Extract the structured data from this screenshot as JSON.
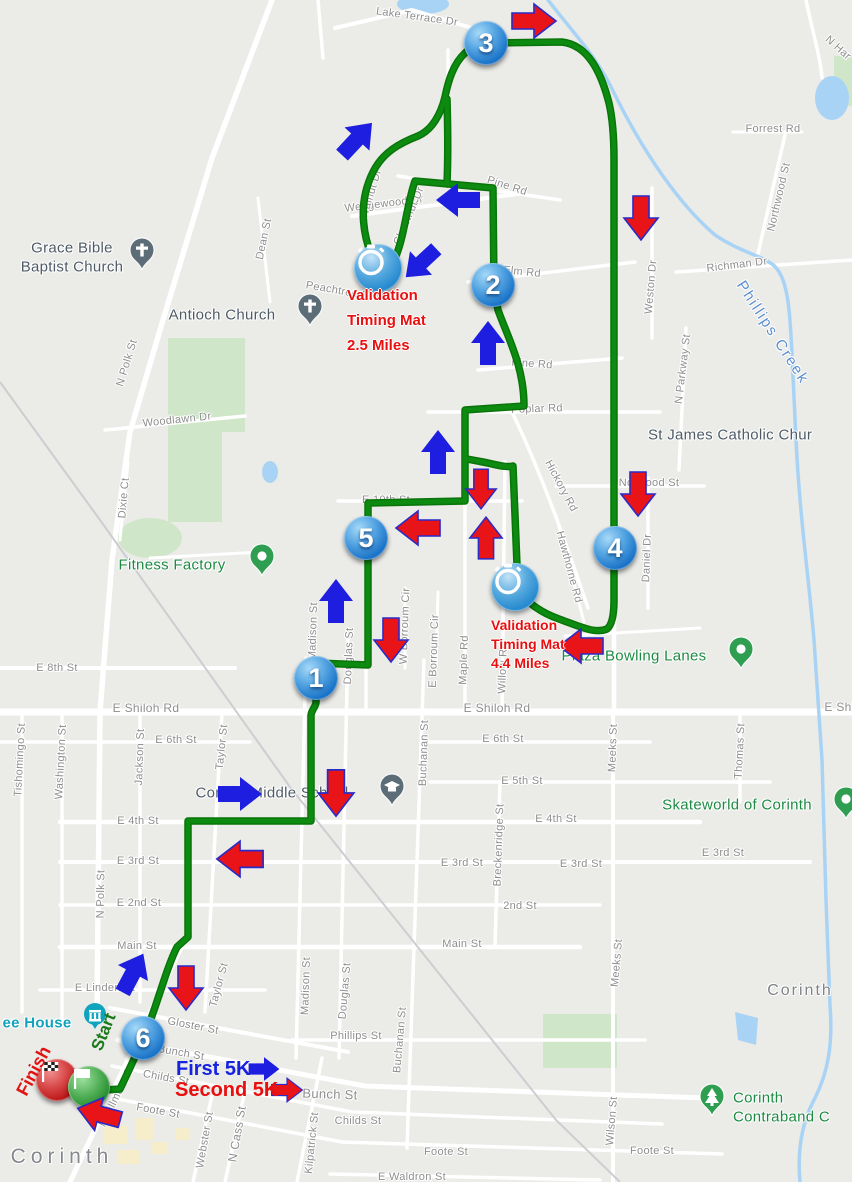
{
  "map": {
    "bg": "#ebebe8",
    "road_color": "#ffffff",
    "park_color": "#cfe7c8",
    "water_color": "#a9d3f5",
    "railroad_color": "#cdcdd2",
    "route_color": "#0d8a10",
    "route_casing_color": "#097409",
    "arrow_blue": "#1e1ee0",
    "arrow_red": "#e81418",
    "arrow_red_outline": "#2a2ac8",
    "parks": [
      "M 168,338 L 245,338 L 245,432 L 222,432 L 222,522 L 168,522 Z",
      "M 543,1014 h 74 v 54 h -74 Z",
      "M 834,56 h 18 v 50 h -18 Z"
    ],
    "park_ellipses": [
      [
        150,
        538,
        32,
        20
      ]
    ],
    "water_ellipses": [
      [
        423,
        4,
        26,
        10
      ],
      [
        832,
        98,
        17,
        22
      ],
      [
        270,
        472,
        8,
        11
      ]
    ],
    "water_polys": [
      "M 735,1012 L 758,1018 L 756,1045 L 738,1040 Z"
    ],
    "yellow_blocks": [
      [
        82,
        1104,
        20,
        16
      ],
      [
        104,
        1126,
        24,
        18
      ],
      [
        136,
        1118,
        18,
        22
      ],
      [
        118,
        1150,
        22,
        14
      ],
      [
        152,
        1142,
        16,
        12
      ],
      [
        176,
        1128,
        14,
        12
      ]
    ]
  },
  "roads": [
    {
      "d": "M 0,712 H 852",
      "w": 7
    },
    {
      "d": "M 0,668 H 235",
      "w": 4
    },
    {
      "d": "M 0,742 H 250",
      "w": 3.5
    },
    {
      "d": "M 430,742 H 650",
      "w": 3.5
    },
    {
      "d": "M 430,782 H 770",
      "w": 3.5
    },
    {
      "d": "M 60,822 H 700",
      "w": 4.5
    },
    {
      "d": "M 60,862 H 810",
      "w": 4
    },
    {
      "d": "M 60,905 H 600",
      "w": 3.5
    },
    {
      "d": "M 60,947 H 580",
      "w": 4.5
    },
    {
      "d": "M 40,990 H 265",
      "w": 3.5
    },
    {
      "d": "M 292,1040 H 645",
      "w": 3.5
    },
    {
      "d": "M 110,1008 L 348,1052",
      "w": 4
    },
    {
      "d": "M 118,1040 L 365,1086 L 705,1098",
      "w": 5
    },
    {
      "d": "M 112,1066 L 352,1112 L 662,1124",
      "w": 3.5
    },
    {
      "d": "M 102,1096 L 342,1142 L 722,1154",
      "w": 3.5
    },
    {
      "d": "M 330,1174 L 600,1180",
      "w": 3.5
    },
    {
      "d": "M 556,486 H 704",
      "w": 3.5
    },
    {
      "d": "M 676,272 L 852,260",
      "w": 3.5
    },
    {
      "d": "M 733,132 H 802",
      "w": 3
    },
    {
      "d": "M 785,135 L 757,258",
      "w": 3.5
    },
    {
      "d": "M 428,412 H 660",
      "w": 3.5
    },
    {
      "d": "M 398,176 L 560,200",
      "w": 3.5
    },
    {
      "d": "M 468,282 L 635,262",
      "w": 3.5
    },
    {
      "d": "M 478,370 L 622,358",
      "w": 3.5
    },
    {
      "d": "M 338,501 H 522",
      "w": 3.5
    },
    {
      "d": "M 105,430 L 245,416",
      "w": 3.5
    },
    {
      "d": "M 512,412 C 540,470 565,540 588,608",
      "w": 3.5
    },
    {
      "d": "M 556,515 L 584,622",
      "w": 3
    },
    {
      "d": "M 22,712 V 1012",
      "w": 3.5
    },
    {
      "d": "M 62,712 V 1022",
      "w": 3.5
    },
    {
      "d": "M 140,712 V 1002",
      "w": 3.5
    },
    {
      "d": "M 222,712 L 205,1012",
      "w": 3.5
    },
    {
      "d": "M 306,658 L 296,1058",
      "w": 3.5
    },
    {
      "d": "M 348,640 L 339,1058",
      "w": 3.5
    },
    {
      "d": "M 424,660 L 407,1148",
      "w": 3.5
    },
    {
      "d": "M 500,782 L 495,945",
      "w": 3.5
    },
    {
      "d": "M 613,712 V 1182",
      "w": 4
    },
    {
      "d": "M 740,712 V 802",
      "w": 3.5
    },
    {
      "d": "M 648,478 V 608",
      "w": 3.5
    },
    {
      "d": "M 652,188 V 338",
      "w": 3.5
    },
    {
      "d": "M 686,328 L 679,470",
      "w": 3.5
    },
    {
      "d": "M 322,1058 L 297,1182",
      "w": 3.5
    },
    {
      "d": "M 214,1086 L 193,1182",
      "w": 3.5
    },
    {
      "d": "M 246,1086 L 225,1182",
      "w": 3.5
    },
    {
      "d": "M 272,0 L 212,158 L 160,330 L 130,432 L 112,560 L 100,712 L 97,1012",
      "w": 5.5
    },
    {
      "d": "M 187,935 L 70,1182",
      "w": 5
    },
    {
      "d": "M 335,28 L 412,10 L 472,28 L 508,48",
      "w": 4
    },
    {
      "d": "M 352,216 L 525,193",
      "w": 4
    },
    {
      "d": "M 318,0 L 323,58",
      "w": 3.5
    },
    {
      "d": "M 258,198 L 270,302",
      "w": 3
    },
    {
      "d": "M 614,140 V 712",
      "w": 4.5
    },
    {
      "d": "M 465,408 V 712",
      "w": 3.5
    },
    {
      "d": "M 505,462 L 502,712",
      "w": 3.5
    },
    {
      "d": "M 405,588 V 668",
      "w": 3
    },
    {
      "d": "M 438,592 L 436,666",
      "w": 3
    },
    {
      "d": "M 366,498 V 712",
      "w": 3.5
    },
    {
      "d": "M 128,462 L 120,540",
      "w": 3
    },
    {
      "d": "M 448,50 L 448,186",
      "w": 3.5
    },
    {
      "d": "M 806,0 C 812,30 820,55 822,78",
      "w": 3.5
    },
    {
      "d": "M 565,636 L 700,628",
      "w": 3
    },
    {
      "d": "M 150,558 L 262,552",
      "w": 3
    }
  ],
  "railroad": {
    "d": "M 0,382 L 100,520 L 290,787 L 556,1120 L 620,1182",
    "w": 2
  },
  "creek": {
    "d": "M 548,0 C 575,35 598,58 615,95 C 645,155 680,205 715,235 C 740,252 760,255 772,264 C 788,275 790,310 792,355 L 796,440 C 800,520 808,570 814,640 L 822,760 L 826,900 L 830,1005 C 833,1045 828,1072 815,1098 C 802,1122 797,1150 800,1182",
    "w": 3.5,
    "label": "Phillips Creek"
  },
  "route": {
    "paths": [
      "M 91,1091 L 120,1089 C 133,1062 141,1044 149,1024 C 159,998 167,967 177,947 L 188,937 L 188,821 L 311,821 L 311,716 C 311,710 316,707 316,702 L 316,663 L 368,665 L 368,503 L 465,501 L 465,410 L 524,406 C 524,366 508,338 498,310 L 494,290 L 493,188 L 415,181 C 407,204 405,233 396,256 L 379,271 C 362,241 357,204 373,172 C 383,152 400,143 418,136 C 432,130 441,114 445,97 C 448,82 453,64 465,53 C 472,46 480,43 488,43 L 562,42 C 588,45 601,72 609,103 C 613,120 614,138 614,160 L 614,600 C 614,614 612,625 607,629 C 595,634 581,627 559,619 C 542,613 527,603 518,590 L 513,466 C 505,468 494,464 483,462 L 467,459",
      "M 447,99 C 448,133 448,160 447,184"
    ]
  },
  "streets": [
    {
      "t": "Lake Terrace Dr",
      "x": 417,
      "y": 17,
      "r": 8
    },
    {
      "t": "Wedgewood Dr",
      "x": 384,
      "y": 204,
      "r": -7
    },
    {
      "t": "Pine Rd",
      "x": 507,
      "y": 186,
      "r": 18
    },
    {
      "t": "Elm Rd",
      "x": 522,
      "y": 272,
      "r": 6
    },
    {
      "t": "Pine Rd",
      "x": 532,
      "y": 364,
      "r": 4
    },
    {
      "t": "Poplar Rd",
      "x": 537,
      "y": 409,
      "r": -2
    },
    {
      "t": "E 10th St",
      "x": 386,
      "y": 500,
      "r": 0
    },
    {
      "t": "Peachtree St",
      "x": 339,
      "y": 291,
      "r": 10
    },
    {
      "t": "Walnut Dr",
      "x": 371,
      "y": 194,
      "r": -73
    },
    {
      "t": "Chestnut Dr",
      "x": 409,
      "y": 216,
      "r": -67
    },
    {
      "t": "Forrest Rd",
      "x": 773,
      "y": 129,
      "r": 0
    },
    {
      "t": "Northwood St",
      "x": 779,
      "y": 197,
      "r": -77
    },
    {
      "t": "Richman Dr",
      "x": 737,
      "y": 265,
      "r": -7
    },
    {
      "t": "N Har",
      "x": 838,
      "y": 48,
      "r": 42
    },
    {
      "t": "Weston Dr",
      "x": 651,
      "y": 287,
      "r": -85
    },
    {
      "t": "N Parkway St",
      "x": 683,
      "y": 369,
      "r": -83
    },
    {
      "t": "Dean St",
      "x": 264,
      "y": 239,
      "r": -78
    },
    {
      "t": "N Polk St",
      "x": 127,
      "y": 363,
      "r": -73
    },
    {
      "t": "Woodlawn Dr",
      "x": 177,
      "y": 420,
      "r": -6
    },
    {
      "t": "Dixie Ct",
      "x": 124,
      "y": 498,
      "r": -85
    },
    {
      "t": "Hickory Rd",
      "x": 561,
      "y": 486,
      "r": 62
    },
    {
      "t": "Hawthorne Rd",
      "x": 569,
      "y": 567,
      "r": 75
    },
    {
      "t": "Norwood St",
      "x": 649,
      "y": 483,
      "r": 0
    },
    {
      "t": "Daniel Dr",
      "x": 647,
      "y": 558,
      "r": -88
    },
    {
      "t": "E 8th St",
      "x": 57,
      "y": 668,
      "r": 0
    },
    {
      "t": "E Shiloh Rd",
      "x": 146,
      "y": 708,
      "r": 0,
      "s": 12
    },
    {
      "t": "E Shiloh Rd",
      "x": 497,
      "y": 708,
      "r": 0,
      "s": 12
    },
    {
      "t": "E Shil",
      "x": 841,
      "y": 707,
      "r": 0,
      "s": 12
    },
    {
      "t": "Tishomingo St",
      "x": 20,
      "y": 760,
      "r": -87
    },
    {
      "t": "Washington St",
      "x": 61,
      "y": 762,
      "r": -87
    },
    {
      "t": "Jackson St",
      "x": 140,
      "y": 757,
      "r": -88
    },
    {
      "t": "Taylor St",
      "x": 222,
      "y": 747,
      "r": -84
    },
    {
      "t": "E 6th St",
      "x": 176,
      "y": 740,
      "r": 0
    },
    {
      "t": "E 6th St",
      "x": 503,
      "y": 739,
      "r": 0
    },
    {
      "t": "E 5th St",
      "x": 522,
      "y": 781,
      "r": 0
    },
    {
      "t": "N Madison St",
      "x": 313,
      "y": 637,
      "r": -88
    },
    {
      "t": "Douglas St",
      "x": 349,
      "y": 656,
      "r": -88
    },
    {
      "t": "W Borroum Cir",
      "x": 405,
      "y": 626,
      "r": -88
    },
    {
      "t": "E Borroum Cir",
      "x": 434,
      "y": 651,
      "r": -88
    },
    {
      "t": "Maple Rd",
      "x": 464,
      "y": 660,
      "r": -88
    },
    {
      "t": "Willow Rd",
      "x": 503,
      "y": 668,
      "r": -88
    },
    {
      "t": "Meeks St",
      "x": 613,
      "y": 748,
      "r": -88
    },
    {
      "t": "Thomas St",
      "x": 740,
      "y": 751,
      "r": -87
    },
    {
      "t": "Buchanan St",
      "x": 424,
      "y": 753,
      "r": -88
    },
    {
      "t": "E 4th St",
      "x": 138,
      "y": 821,
      "r": 0
    },
    {
      "t": "E 4th St",
      "x": 556,
      "y": 819,
      "r": 0
    },
    {
      "t": "E 3rd St",
      "x": 138,
      "y": 861,
      "r": 0
    },
    {
      "t": "E 3rd St",
      "x": 462,
      "y": 863,
      "r": 0
    },
    {
      "t": "E 3rd St",
      "x": 581,
      "y": 864,
      "r": 0
    },
    {
      "t": "E 3rd St",
      "x": 723,
      "y": 853,
      "r": 0
    },
    {
      "t": "Breckenridge St",
      "x": 499,
      "y": 845,
      "r": -88
    },
    {
      "t": "E 2nd St",
      "x": 139,
      "y": 903,
      "r": 0
    },
    {
      "t": "2nd St",
      "x": 520,
      "y": 906,
      "r": 0
    },
    {
      "t": "N Polk St",
      "x": 101,
      "y": 894,
      "r": -89
    },
    {
      "t": "Main St",
      "x": 137,
      "y": 946,
      "r": 0
    },
    {
      "t": "Main St",
      "x": 462,
      "y": 944,
      "r": 0
    },
    {
      "t": "Meeks St",
      "x": 617,
      "y": 963,
      "r": -85
    },
    {
      "t": "E Linden St",
      "x": 105,
      "y": 988,
      "r": 0
    },
    {
      "t": "Madison St",
      "x": 306,
      "y": 986,
      "r": -88
    },
    {
      "t": "Douglas St",
      "x": 345,
      "y": 991,
      "r": -85
    },
    {
      "t": "Taylor St",
      "x": 219,
      "y": 985,
      "r": -75
    },
    {
      "t": "Buchanan St",
      "x": 400,
      "y": 1040,
      "r": -85
    },
    {
      "t": "Gloster St",
      "x": 193,
      "y": 1026,
      "r": 11
    },
    {
      "t": "Bunch St",
      "x": 181,
      "y": 1053,
      "r": 10
    },
    {
      "t": "Bunch St",
      "x": 330,
      "y": 1094,
      "r": 2,
      "s": 13
    },
    {
      "t": "Childs St",
      "x": 166,
      "y": 1078,
      "r": 10
    },
    {
      "t": "Childs St",
      "x": 358,
      "y": 1121,
      "r": 0
    },
    {
      "t": "Foote St",
      "x": 158,
      "y": 1111,
      "r": 10
    },
    {
      "t": "Foote St",
      "x": 446,
      "y": 1152,
      "r": 0
    },
    {
      "t": "Foote St",
      "x": 652,
      "y": 1151,
      "r": 0
    },
    {
      "t": "Phillips St",
      "x": 356,
      "y": 1036,
      "r": 0
    },
    {
      "t": "Kilpatrick St",
      "x": 312,
      "y": 1143,
      "r": -84
    },
    {
      "t": "Webster St",
      "x": 205,
      "y": 1140,
      "r": -80
    },
    {
      "t": "N Cass St",
      "x": 237,
      "y": 1134,
      "r": -80,
      "s": 12
    },
    {
      "t": "N Fillmore St",
      "x": 117,
      "y": 1096,
      "r": -64
    },
    {
      "t": "Wilson St",
      "x": 612,
      "y": 1121,
      "r": -85
    },
    {
      "t": "E Waldron St",
      "x": 412,
      "y": 1177,
      "r": 0
    }
  ],
  "pois": [
    {
      "lines": [
        "Grace Bible",
        "Baptist Church"
      ],
      "x": 72,
      "y": 258,
      "cls": "poi-lbl"
    },
    {
      "lines": [
        "Antioch Church"
      ],
      "x": 222,
      "y": 316,
      "cls": "poi-lbl"
    },
    {
      "lines": [
        "St James Catholic Chur"
      ],
      "x": 648,
      "y": 436,
      "cls": "poi-lbl",
      "align": "left"
    },
    {
      "lines": [
        "Corinth Middle School"
      ],
      "x": 272,
      "y": 794,
      "cls": "poi-lbl"
    },
    {
      "lines": [
        "Skateworld of Corinth"
      ],
      "x": 737,
      "y": 806,
      "cls": "poi-lbl poi-green"
    },
    {
      "lines": [
        "Plaza Bowling Lanes"
      ],
      "x": 634,
      "y": 657,
      "cls": "poi-lbl poi-green"
    },
    {
      "lines": [
        "Fitness Factory"
      ],
      "x": 172,
      "y": 566,
      "cls": "poi-lbl poi-green"
    },
    {
      "lines": [
        "Corinth",
        "Contraband C"
      ],
      "x": 733,
      "y": 1108,
      "cls": "poi-lbl poi-green",
      "align": "left"
    },
    {
      "lines": [
        "ee House"
      ],
      "x": 37,
      "y": 1024,
      "cls": "poi-lbl poi-teal"
    },
    {
      "lines": [
        "Corinth"
      ],
      "x": 800,
      "y": 991,
      "cls": "poi-lbl poi-city"
    },
    {
      "lines": [
        "Corinth"
      ],
      "x": 62,
      "y": 1157,
      "cls": "poi-lbl poi-city2"
    },
    {
      "lines": [
        "Phillips Creek"
      ],
      "x": 772,
      "y": 333,
      "cls": "poi-lbl poi-water",
      "r": 57
    }
  ],
  "pins": [
    {
      "type": "church",
      "x": 142,
      "y": 257
    },
    {
      "type": "church",
      "x": 310,
      "y": 313
    },
    {
      "type": "school",
      "x": 392,
      "y": 793
    },
    {
      "type": "dot",
      "x": 262,
      "y": 563
    },
    {
      "type": "dot",
      "x": 741,
      "y": 656
    },
    {
      "type": "dot",
      "x": 846,
      "y": 806
    },
    {
      "type": "tree",
      "x": 712,
      "y": 1103
    },
    {
      "type": "museum",
      "x": 95,
      "y": 1016
    }
  ],
  "mile_markers": [
    {
      "n": "1",
      "x": 316,
      "y": 678
    },
    {
      "n": "2",
      "x": 493,
      "y": 285
    },
    {
      "n": "3",
      "x": 486,
      "y": 43
    },
    {
      "n": "4",
      "x": 615,
      "y": 548
    },
    {
      "n": "5",
      "x": 366,
      "y": 538
    },
    {
      "n": "6",
      "x": 143,
      "y": 1038
    }
  ],
  "timing_mats": [
    [
      378,
      268
    ],
    [
      515,
      587
    ]
  ],
  "flags": {
    "finish": {
      "x": 57,
      "y": 1080
    },
    "start": {
      "x": 89,
      "y": 1087
    }
  },
  "arrows": {
    "blue": [
      [
        133,
        973,
        -62,
        1
      ],
      [
        240,
        794,
        0,
        1
      ],
      [
        336,
        601,
        -90,
        1
      ],
      [
        438,
        452,
        -90,
        1
      ],
      [
        488,
        343,
        -90,
        1
      ],
      [
        458,
        200,
        180,
        1
      ],
      [
        421,
        263,
        137,
        0.95
      ],
      [
        357,
        139,
        -47,
        1
      ],
      [
        264,
        1069,
        0,
        0.7
      ]
    ],
    "red": [
      [
        534,
        21,
        0,
        1
      ],
      [
        641,
        218,
        90,
        1
      ],
      [
        638,
        494,
        90,
        1
      ],
      [
        581,
        646,
        180,
        1
      ],
      [
        481,
        489,
        90,
        0.9
      ],
      [
        486,
        538,
        -90,
        0.95
      ],
      [
        418,
        528,
        180,
        1
      ],
      [
        391,
        640,
        90,
        1
      ],
      [
        336,
        793,
        90,
        1.05
      ],
      [
        240,
        859,
        180,
        1.05
      ],
      [
        186,
        988,
        90,
        1
      ],
      [
        99,
        1114,
        195,
        1
      ],
      [
        287,
        1090,
        0,
        0.7
      ]
    ]
  },
  "annotations": {
    "val1": {
      "l1": "Validation",
      "l2": "Timing Mat",
      "l3": "2.5 Miles",
      "x": 347,
      "y": 283
    },
    "val2": {
      "l1": "Validation",
      "l2": "Timing Mat",
      "l3": "4.4 Miles",
      "x": 491,
      "y": 616
    },
    "first5k": {
      "text": "First 5K",
      "x": 176,
      "y": 1058
    },
    "second5k": {
      "text": "Second 5K",
      "x": 175,
      "y": 1079
    },
    "finish": {
      "text": "Finish",
      "x": 34,
      "y": 1071,
      "r": -62
    },
    "start": {
      "text": "Start",
      "x": 104,
      "y": 1032,
      "r": -68
    }
  }
}
